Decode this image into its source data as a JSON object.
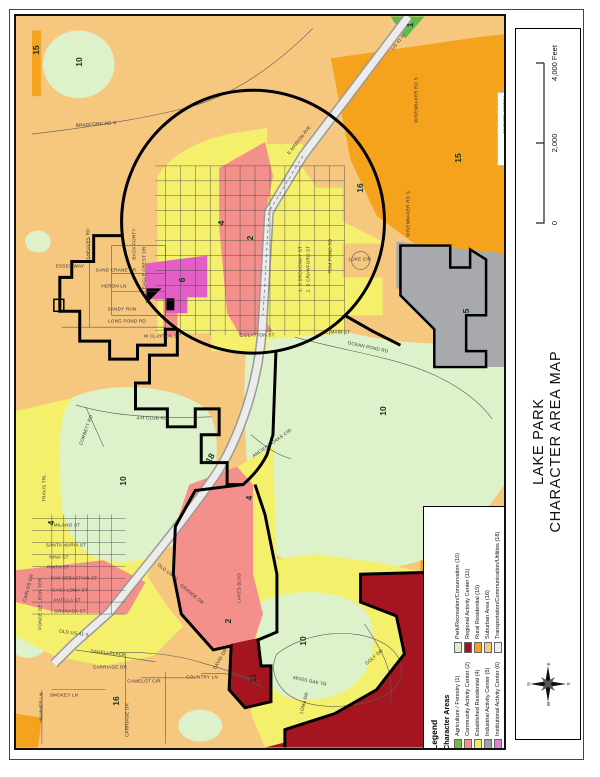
{
  "title_block": {
    "title_line1": "LAKE PARK",
    "title_line2": "CHARACTER AREA MAP",
    "scale": {
      "t0": "0",
      "t1": "2,000",
      "t2": "4,000 Feet"
    },
    "compass": {
      "n": "N",
      "e": "E",
      "s": "S",
      "w": "W"
    }
  },
  "logo": {
    "letters": [
      {
        "ch": "s",
        "color": "#0A9FA8"
      },
      {
        "ch": "g",
        "color": "#0A9FA8"
      },
      {
        "ch": "r",
        "color": "#7DC243"
      },
      {
        "ch": "c",
        "color": "#CE2027"
      }
    ],
    "line1": "SOUTHERN GEORGIA",
    "line1_color": "#16406E",
    "line2": "REGIONAL COMMISSION",
    "line2_color": "#E87511"
  },
  "legend": {
    "title": "Legend",
    "subtitle": "Character Areas",
    "columns": [
      [
        {
          "label": "Agriculture / Forestry (1)",
          "color": "#6FBE47"
        },
        {
          "label": "Community Activity Center (2)",
          "color": "#F4908C"
        },
        {
          "label": "Established Residential (4)",
          "color": "#F2EC63"
        },
        {
          "label": "Industrial Activity Center (5)",
          "color": "#9EA0A3"
        },
        {
          "label": "Institutional Activity Center (6)",
          "color": "#E77FD0"
        }
      ],
      [
        {
          "label": "Park/Recreation/Conservation (10)",
          "color": "#D8F0C4"
        },
        {
          "label": "Regional Activity Center (11)",
          "color": "#A5121F"
        },
        {
          "label": "Rural Residential (15)",
          "color": "#F6A01F"
        },
        {
          "label": "Suburban Area (16)",
          "color": "#F6C883"
        },
        {
          "label": "Transportation/Communication/Utilities (18)",
          "color": "#EFEFED"
        }
      ]
    ]
  },
  "map": {
    "colors": {
      "suburban": "#F6C77E",
      "rural": "#F5A21D",
      "park": "#DDF2CA",
      "agriculture": "#5FBB4A",
      "residential": "#F5F06B",
      "community": "#F4908C",
      "institutional": "#E35FC5",
      "industrial": "#A7A9AC",
      "regional": "#A5151F",
      "transport": "#ECECEA",
      "boundary": "#000000",
      "road": "#5A5A5A"
    },
    "region_labels": [
      {
        "t": "15",
        "x": 20,
        "y": 34,
        "r": -90
      },
      {
        "t": "10",
        "x": 63,
        "y": 46,
        "r": -90
      },
      {
        "t": "1",
        "x": 394,
        "y": 9,
        "r": -90
      },
      {
        "t": "16",
        "x": 344,
        "y": 172,
        "r": -90
      },
      {
        "t": "15",
        "x": 442,
        "y": 142,
        "r": -90
      },
      {
        "t": "4",
        "x": 205,
        "y": 207,
        "r": -90
      },
      {
        "t": "2",
        "x": 234,
        "y": 222,
        "r": -90
      },
      {
        "t": "6",
        "x": 166,
        "y": 264,
        "r": -90
      },
      {
        "t": "5",
        "x": 450,
        "y": 295,
        "r": -90
      },
      {
        "t": "10",
        "x": 367,
        "y": 395,
        "r": -90
      },
      {
        "t": "10",
        "x": 107,
        "y": 465,
        "r": -90
      },
      {
        "t": "4",
        "x": 35,
        "y": 507,
        "r": -90
      },
      {
        "t": "18",
        "x": 194,
        "y": 442,
        "r": -60
      },
      {
        "t": "4",
        "x": 233,
        "y": 482,
        "r": -90
      },
      {
        "t": "2",
        "x": 212,
        "y": 605,
        "r": -90
      },
      {
        "t": "16",
        "x": 100,
        "y": 685,
        "r": -90
      },
      {
        "t": "10",
        "x": 287,
        "y": 625,
        "r": -90
      },
      {
        "t": "11",
        "x": 237,
        "y": 662,
        "r": -90
      }
    ],
    "street_labels": [
      {
        "t": "BRADFORD RD S",
        "x": 80,
        "y": 108,
        "r": -4
      },
      {
        "t": "US 41 N",
        "x": 382,
        "y": 26,
        "r": -52
      },
      {
        "t": "E MARION AVE",
        "x": 283,
        "y": 124,
        "r": -52
      },
      {
        "t": "WISENBAKER RD S",
        "x": 400,
        "y": 84,
        "r": -90
      },
      {
        "t": "WISENBAKER RD S",
        "x": 392,
        "y": 198,
        "r": -90
      },
      {
        "t": "LUKE CIR",
        "x": 344,
        "y": 243,
        "r": 0
      },
      {
        "t": "TOM POND RD",
        "x": 314,
        "y": 240,
        "r": -90
      },
      {
        "t": "LONG POND RD",
        "x": 111,
        "y": 305,
        "r": 0
      },
      {
        "t": "SHEAVES RD",
        "x": 72,
        "y": 228,
        "r": -90
      },
      {
        "t": "BACK FORTY",
        "x": 118,
        "y": 228,
        "r": -90
      },
      {
        "t": "ESSEX WAY",
        "x": 54,
        "y": 250,
        "r": 0
      },
      {
        "t": "SAND CRANE DR",
        "x": 100,
        "y": 254,
        "r": 0
      },
      {
        "t": "HERON LN",
        "x": 98,
        "y": 270,
        "r": 0
      },
      {
        "t": "SANDY RUN",
        "x": 106,
        "y": 293,
        "r": 0
      },
      {
        "t": "EAGLE CREST DR",
        "x": 128,
        "y": 252,
        "r": -90
      },
      {
        "t": "4-H CLUB RD",
        "x": 136,
        "y": 402,
        "r": 0
      },
      {
        "t": "CORBETT RD",
        "x": 70,
        "y": 414,
        "r": -70
      },
      {
        "t": "OCEAN POND RD",
        "x": 352,
        "y": 331,
        "r": 12
      },
      {
        "t": "ANCIENT OAKS CIR",
        "x": 256,
        "y": 427,
        "r": -35
      },
      {
        "t": "OLD US 41",
        "x": 152,
        "y": 556,
        "r": 38
      },
      {
        "t": "OLD US 41 S",
        "x": 58,
        "y": 617,
        "r": 8
      },
      {
        "t": "MILANO ST",
        "x": 51,
        "y": 509,
        "r": 0
      },
      {
        "t": "SANTA MARIA ST",
        "x": 50,
        "y": 529,
        "r": 0
      },
      {
        "t": "NINA ST",
        "x": 43,
        "y": 541,
        "r": 0
      },
      {
        "t": "PINTA ST",
        "x": 42,
        "y": 551,
        "r": 0
      },
      {
        "t": "SAN SEBASTIAN ST",
        "x": 58,
        "y": 562,
        "r": 0
      },
      {
        "t": "CASA LOMA ST",
        "x": 54,
        "y": 574,
        "r": 0
      },
      {
        "t": "ANTILLA ST",
        "x": 51,
        "y": 584,
        "r": 0
      },
      {
        "t": "GRANADA ST",
        "x": 54,
        "y": 595,
        "r": 0
      },
      {
        "t": "DANELI PLACE",
        "x": 92,
        "y": 637,
        "r": 6
      },
      {
        "t": "PONCE DE LEON TER",
        "x": 24,
        "y": 588,
        "r": -90
      },
      {
        "t": "CARLOS DR",
        "x": 12,
        "y": 572,
        "r": -75
      },
      {
        "t": "TRAVIS TRL",
        "x": 28,
        "y": 472,
        "r": -90
      },
      {
        "t": "LAKES BLVD",
        "x": 223,
        "y": 572,
        "r": -90
      },
      {
        "t": "GRANDE DR",
        "x": 176,
        "y": 578,
        "r": 40
      },
      {
        "t": "CARRIAGE DR",
        "x": 94,
        "y": 651,
        "r": 0
      },
      {
        "t": "CARRIAGE DR",
        "x": 111,
        "y": 704,
        "r": -90
      },
      {
        "t": "CAMELOT CIR",
        "x": 128,
        "y": 665,
        "r": 0
      },
      {
        "t": "COUNTRY LN",
        "x": 186,
        "y": 661,
        "r": 0
      },
      {
        "t": "HAMMER LN",
        "x": 25,
        "y": 691,
        "r": -90
      },
      {
        "t": "SMOKEY LN",
        "x": 48,
        "y": 679,
        "r": 0
      },
      {
        "t": "DAVID DR",
        "x": 204,
        "y": 643,
        "r": -60
      },
      {
        "t": "GOLF DR",
        "x": 358,
        "y": 641,
        "r": -40
      },
      {
        "t": "MOSS OAK TR",
        "x": 294,
        "y": 665,
        "r": 12
      },
      {
        "t": "LOMA DR",
        "x": 288,
        "y": 687,
        "r": -75
      },
      {
        "t": "E MAIN ST",
        "x": 322,
        "y": 316,
        "r": 0
      },
      {
        "t": "E CLAYTON ST",
        "x": 241,
        "y": 319,
        "r": 0
      },
      {
        "t": "W CLAYTON ST",
        "x": 146,
        "y": 320,
        "r": 0
      },
      {
        "t": "1. S BROADWAY ST",
        "x": 284,
        "y": 253,
        "r": -90
      },
      {
        "t": "2. S CRAWFORD ST",
        "x": 292,
        "y": 253,
        "r": -90
      }
    ]
  }
}
